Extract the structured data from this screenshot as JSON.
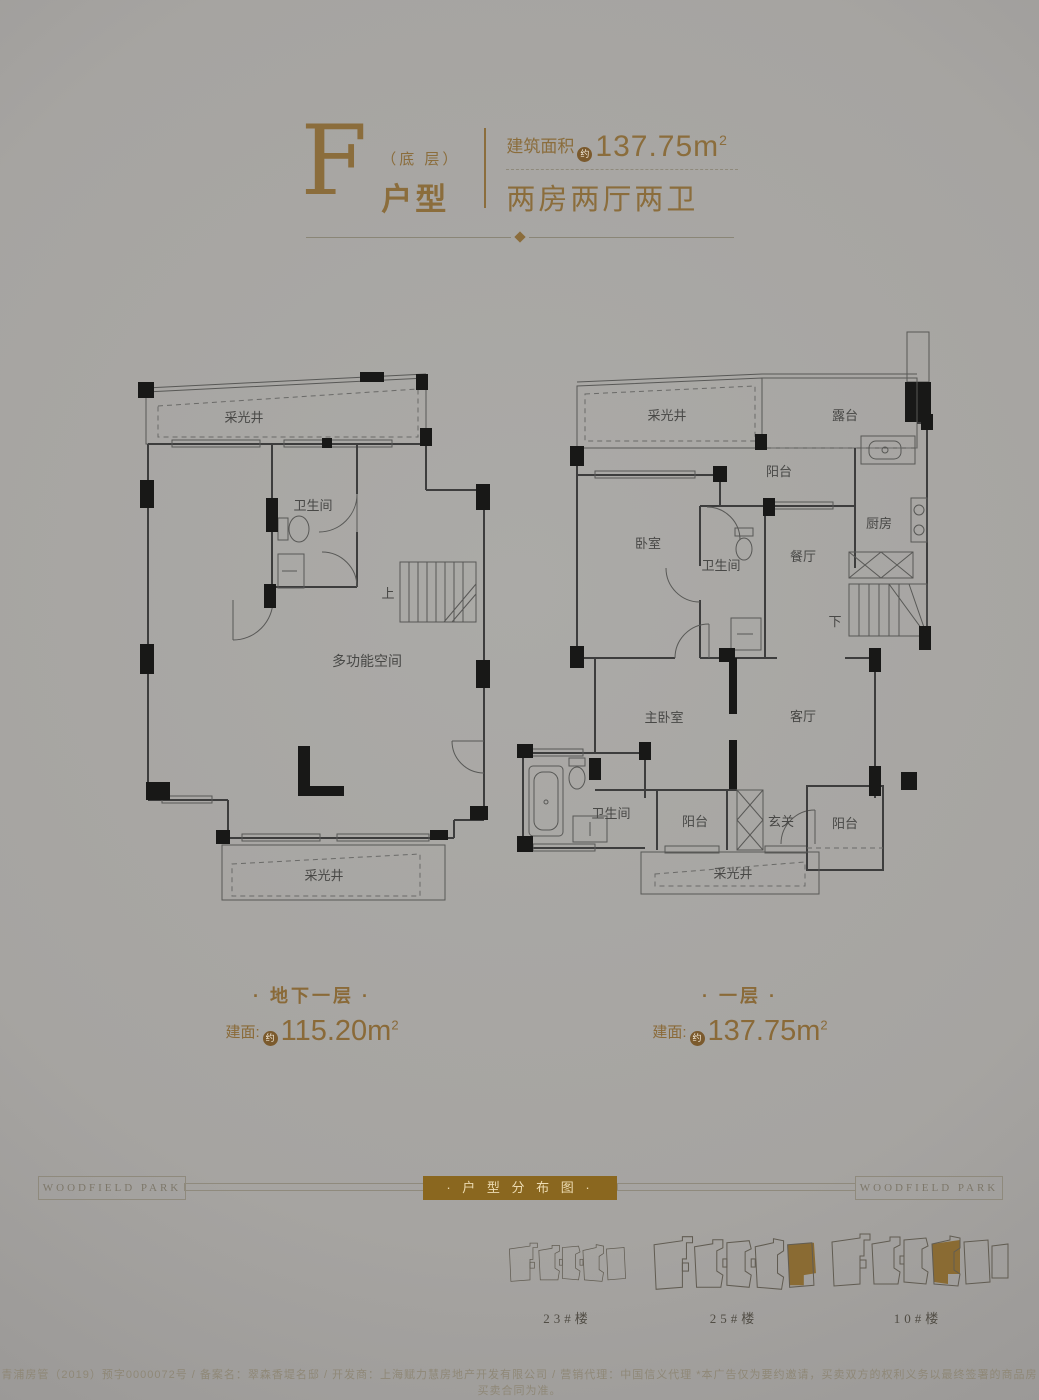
{
  "header": {
    "letter": "F",
    "floor_note": "（底 层）",
    "type_label": "户型",
    "area_label": "建筑面积",
    "approx": "约",
    "area_value": "137.75m",
    "area_sup": "2",
    "layout": "两房两厅两卫"
  },
  "plans": {
    "basement": {
      "title": "· 地下一层 ·",
      "area_prefix": "建面:",
      "approx": "约",
      "area_value": "115.20m",
      "area_sup": "2",
      "rooms": {
        "lightwell_top": "采光井",
        "bath": "卫生间",
        "stairs_up": "上",
        "multi": "多功能空间",
        "lightwell_bottom": "采光井"
      }
    },
    "first": {
      "title": "· 一层 ·",
      "area_prefix": "建面:",
      "approx": "约",
      "area_value": "137.75m",
      "area_sup": "2",
      "rooms": {
        "lightwell_top": "采光井",
        "terrace": "露台",
        "balcony_top": "阳台",
        "bedroom": "卧室",
        "bath_mid": "卫生间",
        "dining": "餐厅",
        "kitchen": "厨房",
        "stairs_down": "下",
        "master": "主卧室",
        "living": "客厅",
        "bath_low": "卫生间",
        "balcony_b1": "阳台",
        "foyer": "玄关",
        "balcony_b2": "阳台",
        "lightwell_bottom": "采光井"
      }
    }
  },
  "banner": {
    "brand_left": "WOODFIELD PARK",
    "title": "· 户 型 分 布 图 ·",
    "brand_right": "WOODFIELD PARK"
  },
  "buildings": [
    {
      "label": "23#楼",
      "highlighted": false
    },
    {
      "label": "25#楼",
      "highlighted": true
    },
    {
      "label": "10#楼",
      "highlighted": true
    }
  ],
  "footer": {
    "legal": "青浦房管（2019）预字0000072号 / 备案名：翠森香堤名邸 / 开发商：上海赋力慧房地产开发有限公司 / 营销代理：中国信义代理 *本广告仅为要约邀请，买卖双方的权利义务以最终签署的商品房买卖合同为准。"
  },
  "colors": {
    "accent_gold": "#8b6d3c",
    "banner_gold": "#8a671f",
    "unit_highlight": "#8a6b33",
    "background": "#a6a4a1"
  }
}
